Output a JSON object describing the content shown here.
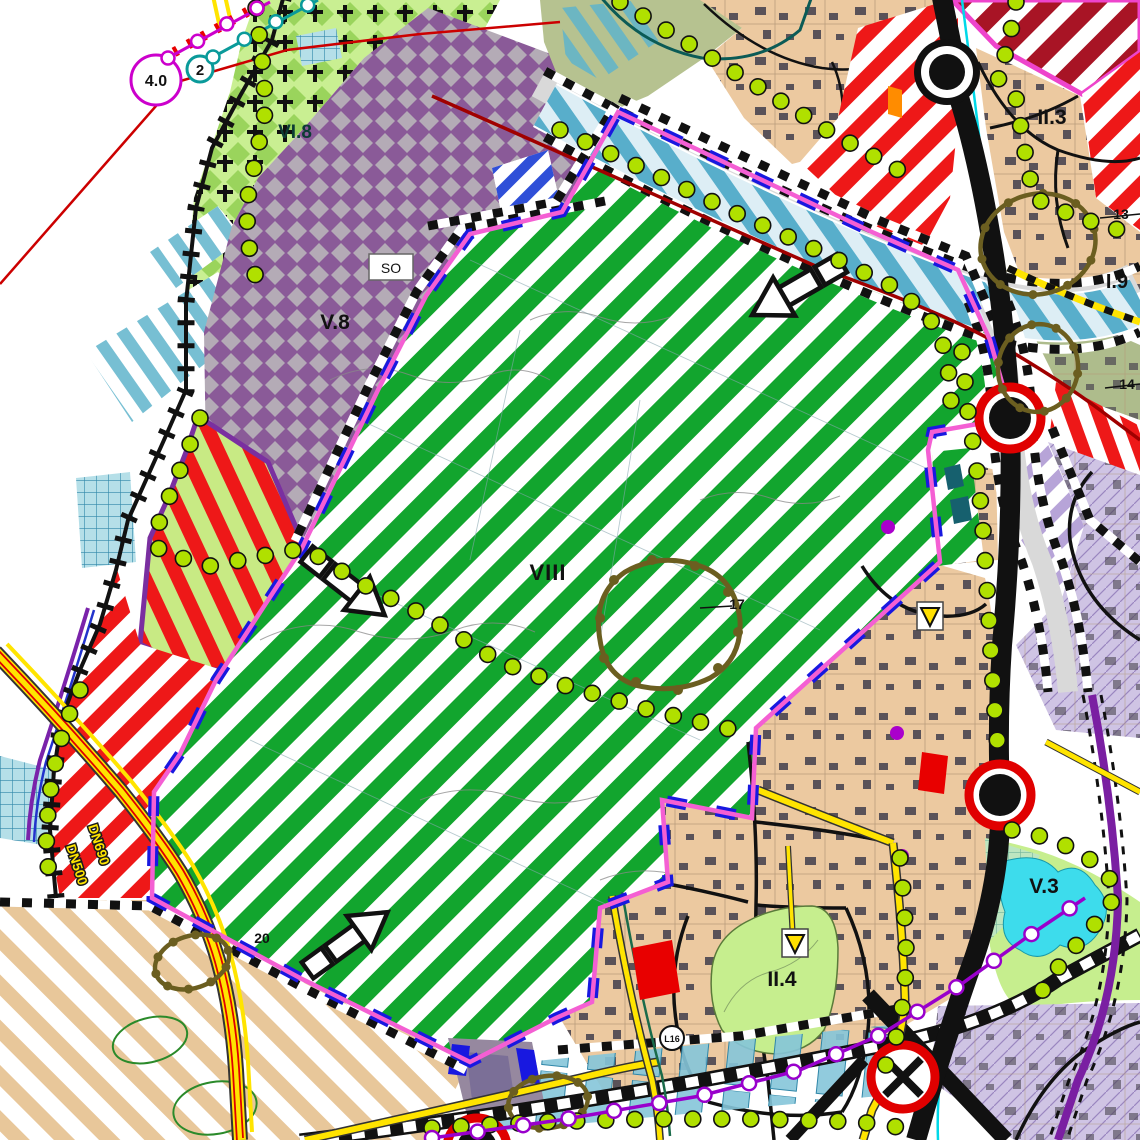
{
  "map": {
    "type": "urban-zoning-plan",
    "labels": {
      "node_40": "4.0",
      "node_2": "2",
      "zone_vi8": "VI.8",
      "so_box": "SO",
      "zone_v8": "V.8",
      "zone_viii": "VIII",
      "ref_13": "13",
      "ref_14": "14",
      "ref_17": "17",
      "ref_20": "20",
      "zone_i9": "I.9",
      "zone_ii3": "II.3",
      "zone_ii4": "II.4",
      "zone_v3": "V.3",
      "road_l16": "L16",
      "road_dn690": "DN690",
      "road_dn500": "DN500"
    },
    "colors": {
      "green_zone": "#12a52e",
      "purple_zone": "#8a5a98",
      "residential_tan": "#ecc9a0",
      "red_zone": "#ee1818",
      "dark_red_zone": "#a81425",
      "park_green": "#c6ee8e",
      "lake_cyan": "#3ddcec",
      "lavender_zone": "#cfc4e4",
      "boundary_pink": "#f45fd3",
      "boundary_blue": "#1818e0",
      "road_yellow": "#ffe400",
      "dot_green": "#b0e000",
      "line_magenta": "#cc00cc",
      "line_teal": "#0a9a9a",
      "line_red": "#cc0000",
      "line_cyan": "#00d8e8",
      "line_purple": "#9900cc",
      "brown_outline": "#6b5e20"
    }
  }
}
